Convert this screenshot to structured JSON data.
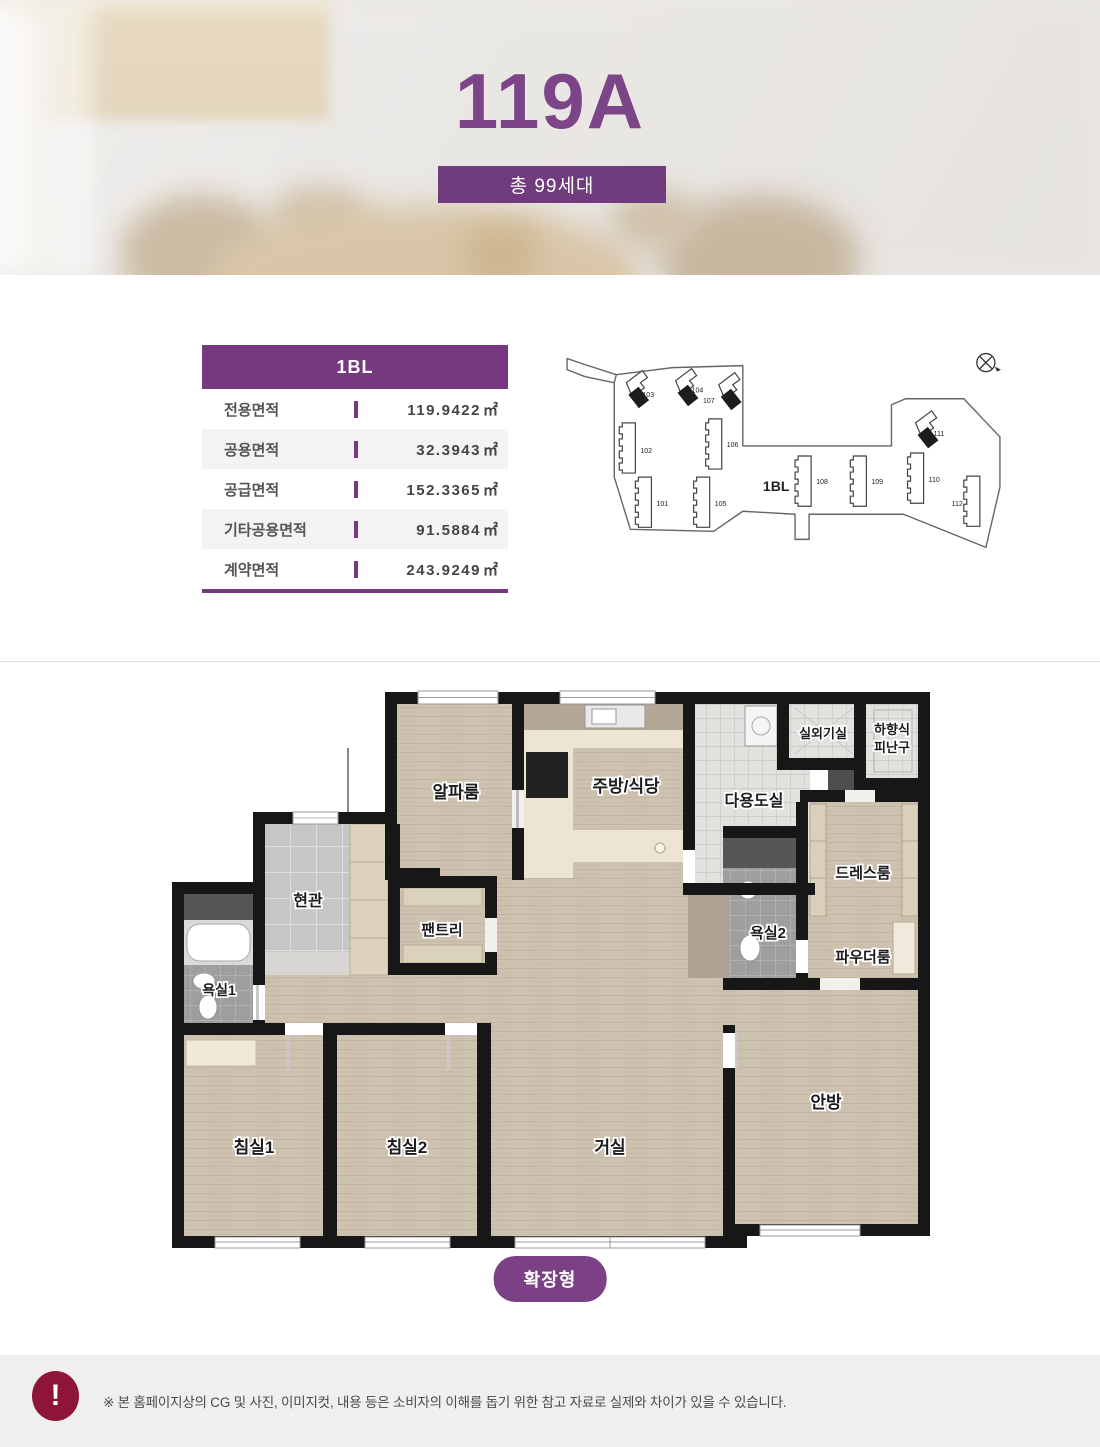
{
  "header": {
    "title": "119A",
    "badge": "총 99세대"
  },
  "info_table": {
    "header": "1BL",
    "rows": [
      {
        "label": "전용면적",
        "value": "119.9422",
        "unit": "㎡"
      },
      {
        "label": "공용면적",
        "value": "32.3943",
        "unit": "㎡"
      },
      {
        "label": "공급면적",
        "value": "152.3365",
        "unit": "㎡"
      },
      {
        "label": "기타공용면적",
        "value": "91.5884",
        "unit": "㎡"
      },
      {
        "label": "계약면적",
        "value": "243.9249",
        "unit": "㎡"
      }
    ]
  },
  "site_plan": {
    "block_label": "1BL",
    "building_numbers": {
      "b101": "101",
      "b102": "102",
      "b103": "103",
      "b104": "104",
      "b105": "105",
      "b106": "106",
      "b107": "107",
      "b108": "108",
      "b109": "109",
      "b110": "110",
      "b111": "111",
      "b112": "112"
    },
    "highlighted_buildings": [
      "103",
      "104",
      "107",
      "111"
    ]
  },
  "floor_plan": {
    "rooms": {
      "alpha": "알파룸",
      "kitchen": "주방/식당",
      "utility": "다용도실",
      "outdoor_unit": "실외기실",
      "escape_line1": "하향식",
      "escape_line2": "피난구",
      "dress": "드레스룸",
      "bath2": "욕실2",
      "powder": "파우더룸",
      "entrance": "현관",
      "pantry": "팬트리",
      "bath1": "욕실1",
      "bed1": "침실1",
      "bed2": "침실2",
      "living": "거실",
      "master": "안방"
    },
    "type_badge": "확장형"
  },
  "footer": {
    "icon_glyph": "!",
    "notice": "※ 본 홈페이지상의 CG 및 사진, 이미지컷, 내용 등은 소비자의 이해를 돕기 위한 참고 자료로 실제와 차이가 있을 수 있습니다."
  },
  "colors": {
    "title_purple": "#7b4587",
    "table_header_purple": "#76387f",
    "badge_purple": "#703c7e",
    "pill_purple": "#7b4086",
    "alert_red": "#8e1537",
    "wall_black": "#171717",
    "wood": "#cdc1b0"
  }
}
